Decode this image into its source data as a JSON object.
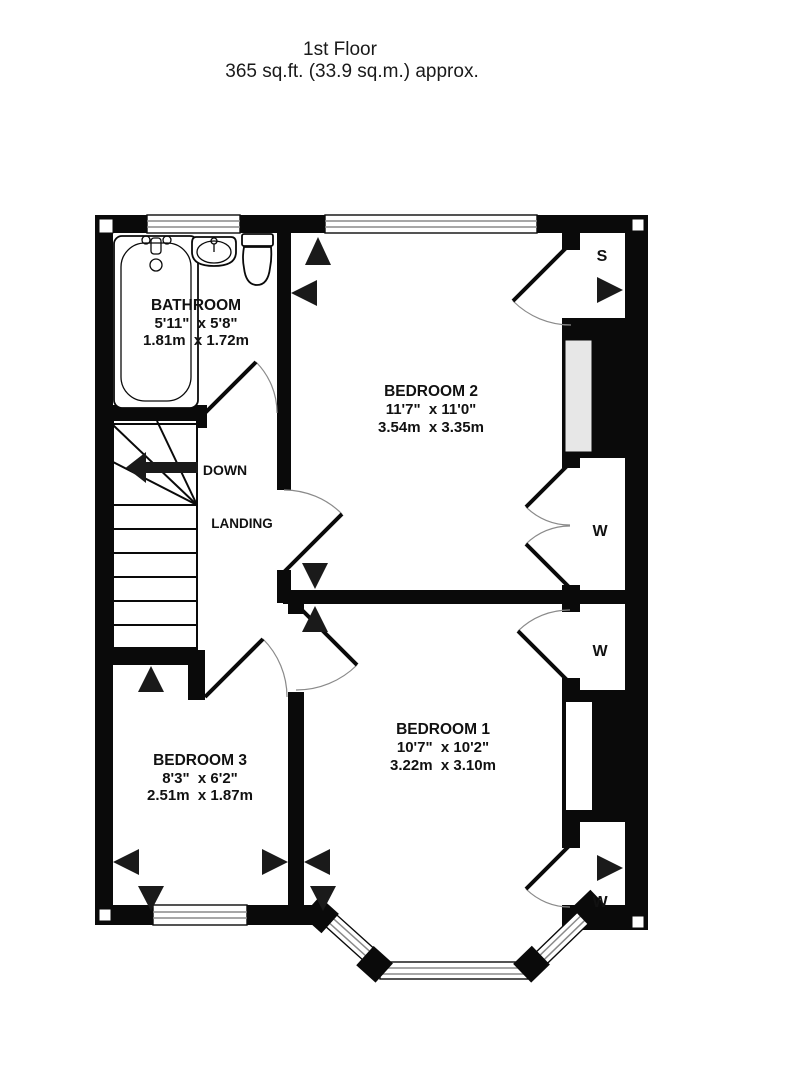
{
  "title": {
    "line1": "1st Floor",
    "line2": "365 sq.ft. (33.9 sq.m.) approx."
  },
  "rooms": {
    "bathroom": {
      "name": "BATHROOM",
      "size_imperial": "5'11\"  x 5'8\"",
      "size_metric": "1.81m  x 1.72m"
    },
    "bedroom2": {
      "name": "BEDROOM 2",
      "size_imperial": "11'7\"  x 11'0\"",
      "size_metric": "3.54m  x 3.35m"
    },
    "bedroom1": {
      "name": "BEDROOM 1",
      "size_imperial": "10'7\"  x 10'2\"",
      "size_metric": "3.22m  x 3.10m"
    },
    "bedroom3": {
      "name": "BEDROOM 3",
      "size_imperial": "8'3\"  x 6'2\"",
      "size_metric": "2.51m  x 1.87m"
    },
    "landing": {
      "name": "LANDING"
    }
  },
  "stairs": {
    "direction_label": "DOWN"
  },
  "features": {
    "storage_label": "S",
    "wardrobe_label": "W"
  },
  "colors": {
    "walls": "#0a0a0a",
    "chimney_recess": "#e7e7e7",
    "window_glazing_line": "#8a8a8a",
    "background": "#ffffff"
  }
}
